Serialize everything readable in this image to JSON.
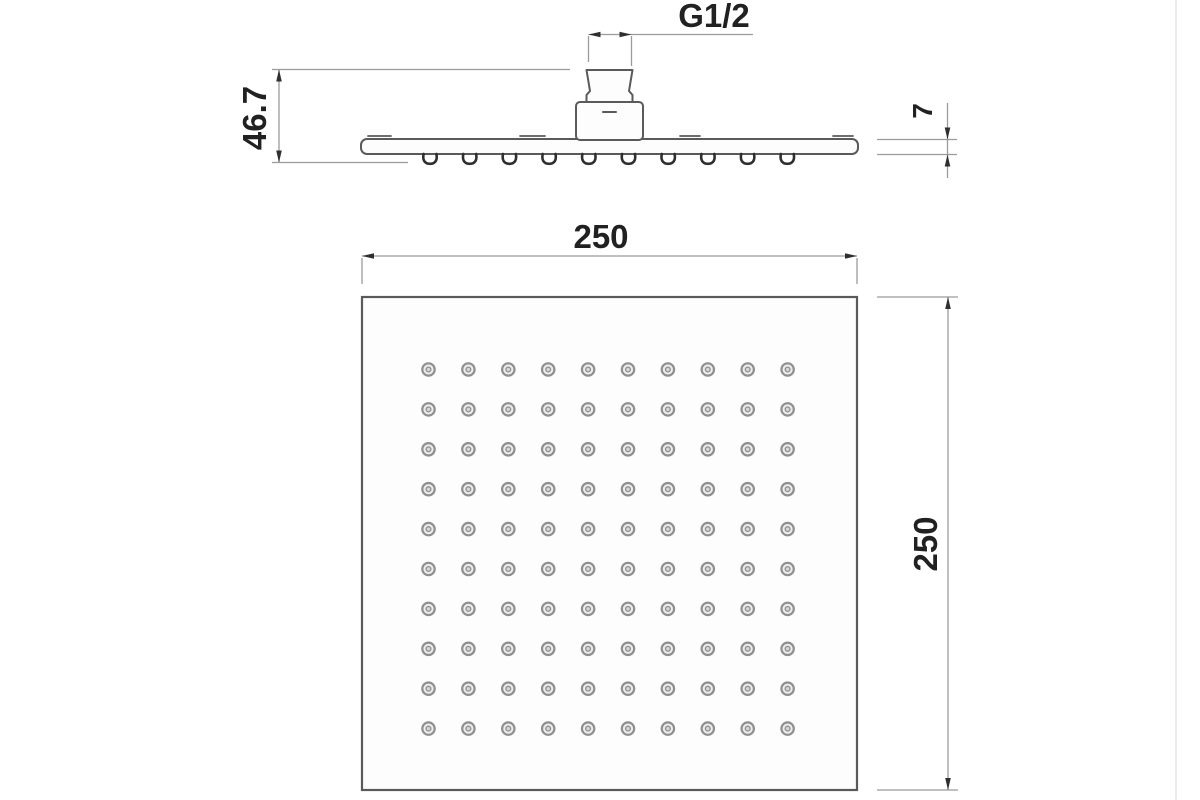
{
  "drawing": {
    "dimensions": {
      "thread_label": "G1/2",
      "total_height": "46.7",
      "plate_thickness": "7",
      "face_width": "250",
      "face_depth": "250"
    },
    "nozzle_grid": {
      "rows": 10,
      "cols": 10
    },
    "side_nozzle_count": 10,
    "colors": {
      "line": "#5a5a5a",
      "dim": "#9b9b9b",
      "arrow": "#2f2f2f",
      "dot": "#8f8f8f",
      "text": "#212121"
    }
  }
}
